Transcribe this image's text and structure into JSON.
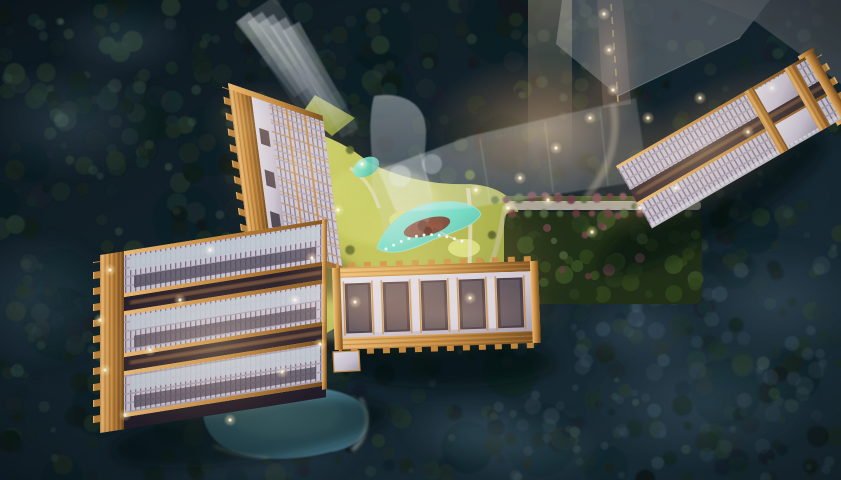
{
  "scene": {
    "palette": {
      "bg_top": "#0e1a21",
      "bg_mid": "#152630",
      "bg_bottom": "#1d323d",
      "forest_colors": [
        "#101c17",
        "#16251e",
        "#1d2f26",
        "#24382c",
        "#1b2d2e",
        "#14222a"
      ],
      "forest_highlights": [
        "#3f5a49",
        "#486652",
        "#55705c"
      ],
      "forest_glints": [
        "#49616f",
        "#54707f"
      ],
      "mist_blue": "#7896af",
      "lake_center": "#7fb9c4",
      "lake_mid": "#5890a2",
      "lake_edge": "#3a6478",
      "lake_rim": "#c9d3c6",
      "pool_light": "#b2f0df",
      "pool_mid": "#69dcc6",
      "pool_deep": "#3fae9c",
      "pool_dot": "#f7fff5",
      "island_light": "#8a5a4c",
      "island_dark": "#5f352e",
      "island_canopy": [
        "#6e3229",
        "#82443a",
        "#5a2a26",
        "#8a5046"
      ],
      "lawn_light": "#d0d672",
      "lawn_mid": "#b9c052",
      "lawn_dark": "#83953c",
      "lawn_mound": "#dde381",
      "path_light": "#e8dfc6",
      "plaza": "#cfc3ae",
      "gold_light": "#f6c177",
      "gold_mid": "#c98a3e",
      "gold_dark": "#7a4d1c",
      "facade_light": "#e9e5ee",
      "facade_mid": "#cfc8d6",
      "facade_dark": "#a49db0",
      "glass": "#c5ccd8",
      "window_dark": "#6f6a7c",
      "recess_dark": "#3b3544",
      "gap_dark": "#241e2b",
      "gap_glow": "#f7a85c",
      "ghost_light": "#f6f8fa",
      "ghost_dark": "#c9ced6",
      "ghost_grey": "#85898f",
      "ghost_grey_dark": "#5d6269",
      "glow_warm": "#ffc87d",
      "light_dot": "#fff6da",
      "road_grey": "#383d42",
      "road_line": "#d9b45e",
      "promenade": "#cdc2b0",
      "flower_trees": [
        "#8d5a62",
        "#6e3d48",
        "#56693f",
        "#7c4a52"
      ],
      "garden_green": "#233219",
      "hedge_green": "#55682f",
      "shadow": "#05090d"
    }
  }
}
